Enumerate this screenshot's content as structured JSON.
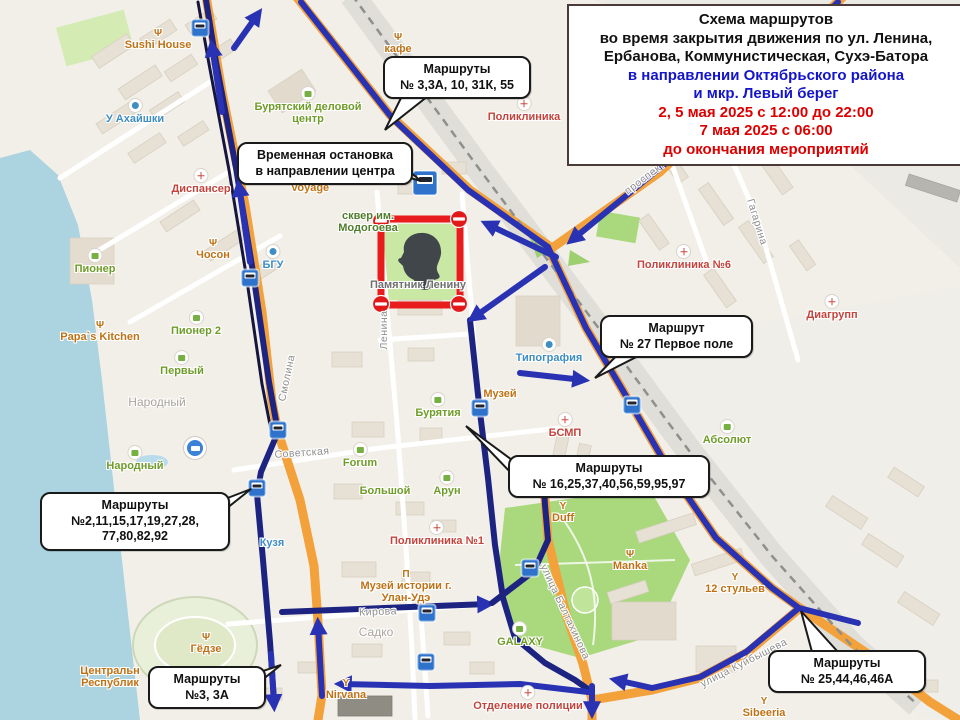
{
  "title_box": {
    "lines": [
      {
        "text": "Схема маршрутов",
        "color": "black"
      },
      {
        "text": "во время закрытия движения по ул. Ленина,",
        "color": "black"
      },
      {
        "text": "Ербанова, Коммунистическая, Сухэ-Батора",
        "color": "black"
      },
      {
        "text": "в направлении Октябрьского района",
        "color": "blue"
      },
      {
        "text": "и мкр. Левый берег",
        "color": "blue"
      },
      {
        "text": "2, 5 мая 2025 с 12:00 до 22:00",
        "color": "red"
      },
      {
        "text": "7 мая 2025 с 06:00",
        "color": "red"
      },
      {
        "text": "до окончания мероприятий",
        "color": "red"
      }
    ]
  },
  "callouts": [
    {
      "name": "callout-routes-3-3a-10-31k-55",
      "x": 383,
      "y": 56,
      "w": 132,
      "lines": [
        "Маршруты",
        "№ 3,3А, 10, 31К, 55"
      ],
      "tail": "385,130 402,96 428,96"
    },
    {
      "name": "callout-temp-stop-center",
      "x": 237,
      "y": 142,
      "w": 160,
      "lines": [
        "Временная остановка",
        "в направлении центра"
      ],
      "tail": "421,181 393,158 393,173"
    },
    {
      "name": "callout-route-27",
      "x": 600,
      "y": 315,
      "w": 137,
      "lines": [
        "Маршрут",
        "№ 27 Первое поле"
      ],
      "tail": "595,378 620,352 646,352"
    },
    {
      "name": "callout-routes-16-25-37-40-56-59-95-97",
      "x": 508,
      "y": 455,
      "w": 186,
      "lines": [
        "Маршруты",
        "№ 16,25,37,40,56,59,95,97"
      ],
      "tail": "466,426 512,460 514,476"
    },
    {
      "name": "callout-routes-2-11-15-17-19-27-28-77-80-82-92",
      "x": 40,
      "y": 492,
      "w": 174,
      "lines": [
        "Маршруты",
        "№2,11,15,17,19,27,28,",
        "77,80,82,92"
      ],
      "tail": "251,489 212,504 212,520"
    },
    {
      "name": "callout-routes-3-3a",
      "x": 148,
      "y": 666,
      "w": 102,
      "lines": [
        "Маршруты",
        "№3, 3А"
      ],
      "tail": "281,665 248,676 248,691"
    },
    {
      "name": "callout-routes-25-44-46-46a",
      "x": 768,
      "y": 650,
      "w": 142,
      "lines": [
        "Маршруты",
        "№ 25,44,46,46А"
      ],
      "tail": "801,611 812,652 838,652"
    }
  ],
  "map_labels": [
    {
      "name": "label-sushi-house",
      "text": "Sushi House",
      "x": 158,
      "y": 40,
      "color": "orange",
      "icon": "fork"
    },
    {
      "name": "label-cafe",
      "text": "кафе",
      "x": 398,
      "y": 44,
      "color": "orange",
      "icon": "fork"
    },
    {
      "name": "label-poliklinika",
      "text": "Поликлиника",
      "x": 524,
      "y": 110,
      "color": "red",
      "icon": "med"
    },
    {
      "name": "label-u-ahaishki",
      "text": "У Ахайшки",
      "x": 135,
      "y": 112,
      "color": "blue",
      "icon": "blue"
    },
    {
      "name": "label-buryatsky-delovoy-centr",
      "text": "Бурятский деловой\nцентр",
      "x": 308,
      "y": 106,
      "color": "green",
      "icon": "bag"
    },
    {
      "name": "label-dispanser",
      "text": "Диспансер",
      "x": 201,
      "y": 182,
      "color": "red",
      "icon": "med"
    },
    {
      "name": "label-voyage",
      "text": "Voyage",
      "x": 310,
      "y": 188,
      "color": "orange"
    },
    {
      "name": "label-choson",
      "text": "Чосон",
      "x": 213,
      "y": 250,
      "color": "orange",
      "icon": "fork"
    },
    {
      "name": "label-bgu",
      "text": "БГУ",
      "x": 273,
      "y": 258,
      "color": "blue",
      "icon": "blue"
    },
    {
      "name": "label-pioner",
      "text": "Пионер",
      "x": 95,
      "y": 262,
      "color": "green",
      "icon": "bag"
    },
    {
      "name": "label-papas-kitchen",
      "text": "Papa`s Kitchen",
      "x": 100,
      "y": 332,
      "color": "orange",
      "icon": "fork"
    },
    {
      "name": "label-pioner-2",
      "text": "Пионер 2",
      "x": 196,
      "y": 324,
      "color": "green",
      "icon": "bag"
    },
    {
      "name": "label-perviy",
      "text": "Первый",
      "x": 182,
      "y": 364,
      "color": "green",
      "icon": "bag"
    },
    {
      "name": "label-narodny-district",
      "text": "Народный",
      "x": 157,
      "y": 402,
      "color": "district"
    },
    {
      "name": "label-narodny-shop",
      "text": "Народный",
      "x": 135,
      "y": 459,
      "color": "green",
      "icon": "bag"
    },
    {
      "name": "label-kuzya",
      "text": "Кузя",
      "x": 272,
      "y": 543,
      "color": "blue"
    },
    {
      "name": "label-skver-modogoeva",
      "text": "сквер им.\nМодогоева",
      "x": 368,
      "y": 222,
      "color": "park"
    },
    {
      "name": "label-pamyatnik-leninu",
      "text": "Памятник Ленину",
      "x": 418,
      "y": 285,
      "color": "gray"
    },
    {
      "name": "label-tipografiya",
      "text": "Типография",
      "x": 549,
      "y": 351,
      "color": "blue",
      "icon": "blue"
    },
    {
      "name": "label-buryatia",
      "text": "Бурятия",
      "x": 438,
      "y": 406,
      "color": "green",
      "icon": "bag"
    },
    {
      "name": "label-muzey",
      "text": "Музей",
      "x": 500,
      "y": 394,
      "color": "orange"
    },
    {
      "name": "label-bsmp",
      "text": "БСМП",
      "x": 565,
      "y": 426,
      "color": "red",
      "icon": "med"
    },
    {
      "name": "label-forum",
      "text": "Forum",
      "x": 360,
      "y": 456,
      "color": "green",
      "icon": "bag"
    },
    {
      "name": "label-bolshoy",
      "text": "Большой",
      "x": 385,
      "y": 491,
      "color": "green"
    },
    {
      "name": "label-arun",
      "text": "Арун",
      "x": 447,
      "y": 484,
      "color": "green",
      "icon": "bag"
    },
    {
      "name": "label-duff",
      "text": "Duff",
      "x": 563,
      "y": 513,
      "color": "orange",
      "icon": "bar"
    },
    {
      "name": "label-poliklinika-1",
      "text": "Поликлиника №1",
      "x": 437,
      "y": 534,
      "color": "red",
      "icon": "med"
    },
    {
      "name": "label-muzey-istorii",
      "text": "Музей истории г.\nУлан-Удэ",
      "x": 406,
      "y": 587,
      "color": "orange",
      "icon": "museum"
    },
    {
      "name": "label-kirova",
      "text": "Кирова",
      "x": 378,
      "y": 612,
      "color": "street",
      "rot": -2
    },
    {
      "name": "label-sadko",
      "text": "Садко",
      "x": 376,
      "y": 632,
      "color": "district"
    },
    {
      "name": "label-galaxy",
      "text": "GALAXY",
      "x": 520,
      "y": 635,
      "color": "green",
      "icon": "bag"
    },
    {
      "name": "label-nirvana",
      "text": "Nirvana",
      "x": 346,
      "y": 690,
      "color": "orange",
      "icon": "bar"
    },
    {
      "name": "label-otdelenie-policii",
      "text": "Отделение полиции",
      "x": 528,
      "y": 699,
      "color": "red",
      "icon": "med"
    },
    {
      "name": "label-manka",
      "text": "Manka",
      "x": 630,
      "y": 561,
      "color": "orange",
      "icon": "fork"
    },
    {
      "name": "label-12-stulyev",
      "text": "12 стульев",
      "x": 735,
      "y": 584,
      "color": "orange",
      "icon": "bar"
    },
    {
      "name": "label-poliklinika-6",
      "text": "Поликлиника №6",
      "x": 684,
      "y": 258,
      "color": "red",
      "icon": "med"
    },
    {
      "name": "label-diagrupp",
      "text": "Диагрупп",
      "x": 832,
      "y": 308,
      "color": "red",
      "icon": "med"
    },
    {
      "name": "label-absolut",
      "text": "Абсолют",
      "x": 727,
      "y": 433,
      "color": "green",
      "icon": "bag"
    },
    {
      "name": "label-gyodze",
      "text": "Гёдзе",
      "x": 206,
      "y": 644,
      "color": "orange",
      "icon": "fork"
    },
    {
      "name": "label-central-stadium",
      "text": "Центральн\nРеспублик",
      "x": 110,
      "y": 677,
      "color": "orange"
    },
    {
      "name": "label-sibeeria",
      "text": "Sibeeria",
      "x": 764,
      "y": 708,
      "color": "orange",
      "icon": "bar"
    },
    {
      "name": "street-gagarina",
      "text": "Гагарина",
      "x": 757,
      "y": 222,
      "color": "street",
      "rot": 73
    },
    {
      "name": "street-smolina",
      "text": "Смолина",
      "x": 287,
      "y": 378,
      "color": "street",
      "rot": -78
    },
    {
      "name": "street-lenina",
      "text": "Ленина",
      "x": 384,
      "y": 330,
      "color": "street",
      "rot": -90
    },
    {
      "name": "street-sovetskaya",
      "text": "Советская",
      "x": 302,
      "y": 453,
      "color": "street",
      "rot": -4
    },
    {
      "name": "street-baltahinova",
      "text": "улица Балтахинова",
      "x": 565,
      "y": 612,
      "color": "street",
      "rot": 65
    },
    {
      "name": "street-kuybysheva",
      "text": "улица Куйбышева",
      "x": 744,
      "y": 663,
      "color": "street",
      "rot": -27
    },
    {
      "name": "street-prospekt",
      "text": "проспект",
      "x": 645,
      "y": 178,
      "color": "street",
      "rot": -37
    }
  ],
  "bus_stops": [
    {
      "x": 200,
      "y": 28
    },
    {
      "x": 425,
      "y": 183,
      "big": true
    },
    {
      "x": 250,
      "y": 278
    },
    {
      "x": 278,
      "y": 430
    },
    {
      "x": 257,
      "y": 488
    },
    {
      "x": 480,
      "y": 408
    },
    {
      "x": 632,
      "y": 405
    },
    {
      "x": 530,
      "y": 568
    },
    {
      "x": 427,
      "y": 613
    },
    {
      "x": 426,
      "y": 662
    },
    {
      "x": 195,
      "y": 448,
      "hub": true
    }
  ],
  "colors": {
    "route_blue": "#2a32b4",
    "route_dark": "#15153d",
    "road_orange": "#f2a13b",
    "closure_red": "#e81c1c",
    "water": "#abd4e0",
    "park_green": "#a9d87d",
    "title_blue": "#1414cc",
    "title_red": "#dd0000"
  }
}
